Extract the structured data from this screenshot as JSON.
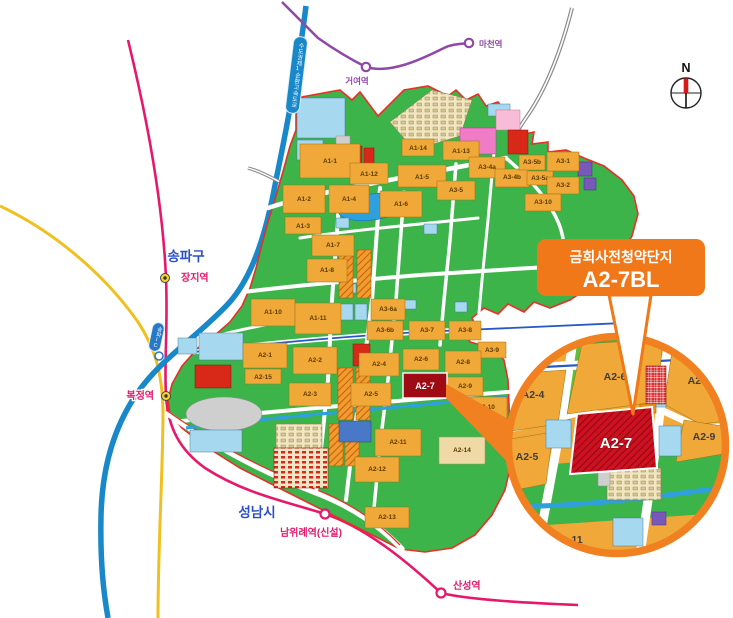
{
  "callout": {
    "title": "금회사전청약단지",
    "block_label": "A2-7BL"
  },
  "compass": {
    "north_label": "N"
  },
  "regions": {
    "songpa": "송파구",
    "seongnam": "성남시"
  },
  "stations": {
    "jangji": "장지역",
    "bokjeong": "복정역",
    "namwirye": "남위례역(신설)",
    "sanseong": "산성역",
    "geoyeo": "거여역",
    "macheon": "마천역"
  },
  "roads": {
    "ring_expressway": "수도권제1순환고속도로",
    "songpa_ic": "송파IC"
  },
  "parcels": {
    "a1_1": "A1-1",
    "a1_2": "A1-2",
    "a1_3": "A1-3",
    "a1_4": "A1-4",
    "a1_5": "A1-5",
    "a1_6": "A1-6",
    "a1_7": "A1-7",
    "a1_8": "A1-8",
    "a1_10": "A1-10",
    "a1_11": "A1-11",
    "a1_12": "A1-12",
    "a1_13": "A1-13",
    "a1_14": "A1-14",
    "a2_1": "A2-1",
    "a2_2": "A2-2",
    "a2_3": "A2-3",
    "a2_4": "A2-4",
    "a2_5": "A2-5",
    "a2_6": "A2-6",
    "a2_8": "A2-8",
    "a2_9": "A2-9",
    "a2_10": "A2-10",
    "a2_11": "A2-11",
    "a2_12": "A2-12",
    "a2_13": "A2-13",
    "a2_14": "A2-14",
    "a2_15": "A2-15",
    "a3_1": "A3-1",
    "a3_2": "A3-2",
    "a3_4a": "A3-4a",
    "a3_4b": "A3-4b",
    "a3_5": "A3-5",
    "a3_5a": "A3-5a",
    "a3_5b": "A3-5b",
    "a3_6a": "A3-6a",
    "a3_6b": "A3-6b",
    "a3_7": "A3-7",
    "a3_8": "A3-8",
    "a3_9": "A3-9",
    "a3_10": "A3-10"
  },
  "highlight": {
    "main_label": "A2-7"
  },
  "inset": {
    "a2_4": "A2-4",
    "a2_5": "A2-5",
    "a2_6": "A2-6",
    "a2_7": "A2-7",
    "a2_8": "A2-8",
    "a2_9": "A2-9",
    "a3_7_partial": "A3-7",
    "bottom_partial": "11"
  },
  "colors": {
    "accent_orange": "#F07818",
    "line8_pink": "#E6186C",
    "line5_purple": "#9048A8",
    "expressway_blue": "#1888C8",
    "road_yellow": "#F0C020",
    "site_green": "#3CB44A",
    "parcel_orange": "#F0A838",
    "parcel_blue": "#A6D9EF",
    "highlight_red": "#9E0B14",
    "inset_red": "#D01020",
    "boundary_red": "#E83028",
    "region_label_blue": "#2b4fc8"
  }
}
